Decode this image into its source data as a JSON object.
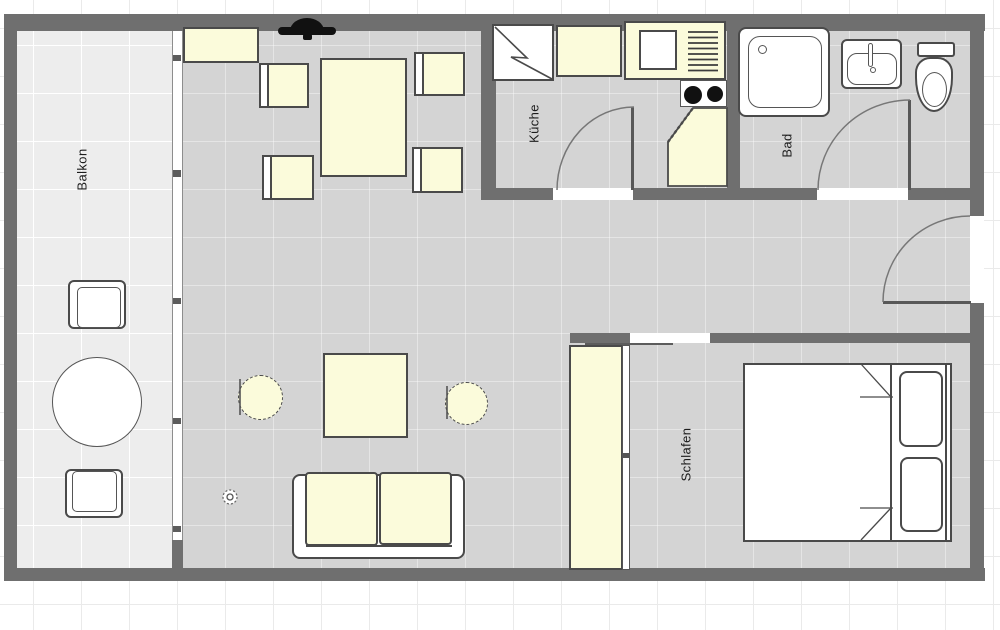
{
  "plan_title": "Apartment floor plan",
  "rooms": {
    "balkon": {
      "label": "Balkon"
    },
    "kueche": {
      "label": "Küche"
    },
    "bad": {
      "label": "Bad"
    },
    "schlafen": {
      "label": "Schlafen"
    }
  },
  "colors": {
    "wall": "#6f6f6f",
    "interior_floor": "#d4d4d4",
    "balcony_floor": "#ededed",
    "furniture_fill": "#fbfbdb",
    "furniture_border": "#4a4a4a",
    "outline": "#555555",
    "burner": "#111111",
    "background": "#ffffff",
    "grid_line": "#eaeaea"
  },
  "furniture": [
    {
      "name": "balcony-chair-top"
    },
    {
      "name": "balcony-round-table"
    },
    {
      "name": "balcony-chair-bottom"
    },
    {
      "name": "sideboard"
    },
    {
      "name": "tv"
    },
    {
      "name": "dining-chair-top-left"
    },
    {
      "name": "dining-chair-top-right"
    },
    {
      "name": "dining-chair-bottom-left"
    },
    {
      "name": "dining-chair-bottom-right"
    },
    {
      "name": "dining-table"
    },
    {
      "name": "lounge-chair-left"
    },
    {
      "name": "coffee-table"
    },
    {
      "name": "lounge-chair-right"
    },
    {
      "name": "sofa"
    },
    {
      "name": "potted-plant"
    },
    {
      "name": "refrigerator"
    },
    {
      "name": "kitchen-counter"
    },
    {
      "name": "kitchen-sink-unit"
    },
    {
      "name": "kitchen-sink"
    },
    {
      "name": "dish-drainer"
    },
    {
      "name": "cooktop"
    },
    {
      "name": "corner-cabinet"
    },
    {
      "name": "shower"
    },
    {
      "name": "bathroom-sink"
    },
    {
      "name": "toilet"
    },
    {
      "name": "wardrobe"
    },
    {
      "name": "double-bed"
    },
    {
      "name": "pillow-top"
    },
    {
      "name": "pillow-bottom"
    }
  ],
  "doors": [
    {
      "name": "kitchen-door",
      "type": "swing"
    },
    {
      "name": "bathroom-door",
      "type": "swing"
    },
    {
      "name": "entry-door",
      "type": "swing"
    },
    {
      "name": "bedroom-door",
      "type": "opening-with-sliding-panel"
    },
    {
      "name": "balcony-window",
      "type": "glazed-front"
    }
  ]
}
